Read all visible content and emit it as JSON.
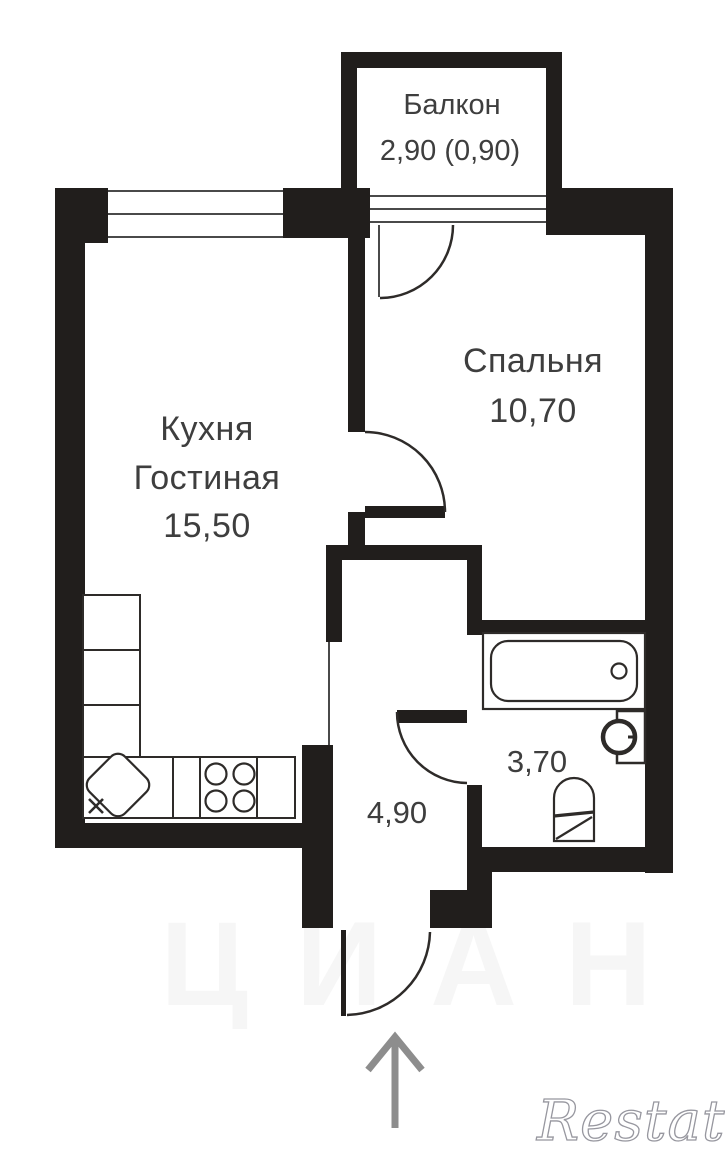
{
  "colors": {
    "wall": "#211e1c",
    "line": "#2e2b29",
    "window_line": "#4a4a4a",
    "label": "#3e3e3e",
    "arrow": "#8d8d8d",
    "watermark_stroke": "#97979f",
    "background": "#ffffff"
  },
  "rooms": {
    "balcony": {
      "name": "Балкон",
      "area": "2,90 (0,90)"
    },
    "bedroom": {
      "name": "Спальня",
      "area": "10,70"
    },
    "kitchen_living": {
      "name_line1": "Кухня",
      "name_line2": "Гостиная",
      "area": "15,50"
    },
    "bathroom": {
      "area": "3,70"
    },
    "hallway": {
      "area": "4,90"
    }
  },
  "watermarks": {
    "brand": "Restate",
    "background": "ЦИАН"
  }
}
